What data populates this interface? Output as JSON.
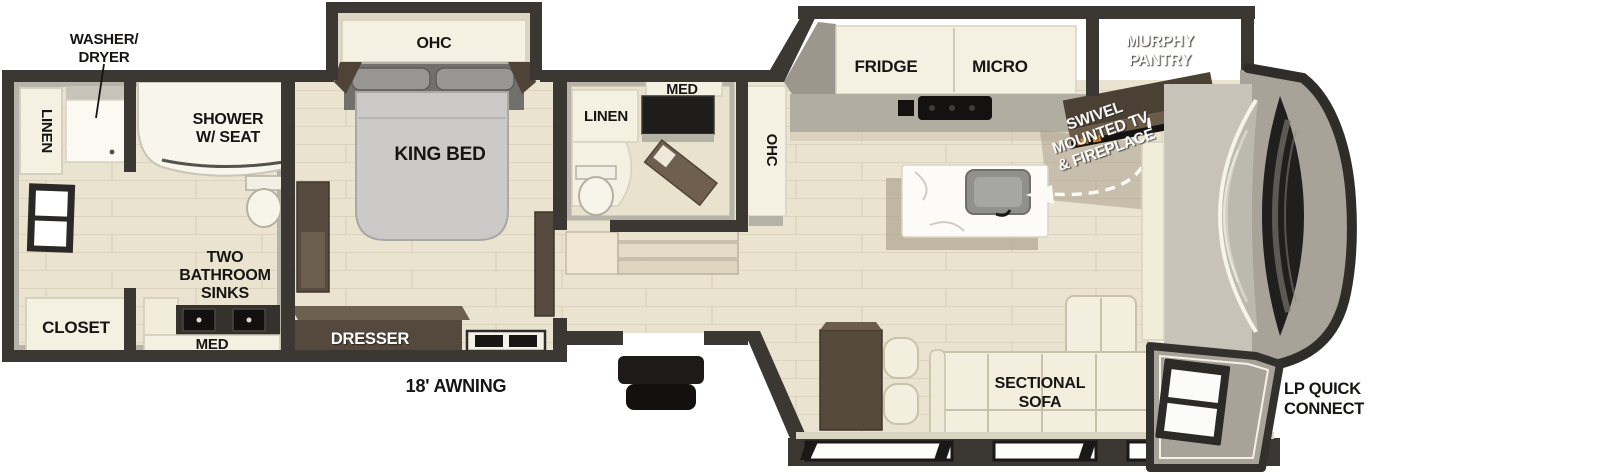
{
  "diagram": {
    "type": "rv-floorplan",
    "labels": {
      "washer_dryer": [
        "WASHER/",
        "DRYER"
      ],
      "linen_rear": "LINEN",
      "shower": [
        "SHOWER",
        "W/ SEAT"
      ],
      "closet": "CLOSET",
      "two_bathroom_sinks": [
        "TWO",
        "BATHROOM",
        "SINKS"
      ],
      "med_rear": "MED",
      "ohc_bedroom": "OHC",
      "king_bed": "KING BED",
      "dresser": "DRESSER",
      "awning": "18' AWNING",
      "linen_mid": "LINEN",
      "med_mid": "MED",
      "ohc_kitchen": "OHC",
      "fridge": "FRIDGE",
      "micro": "MICRO",
      "murphy_pantry": [
        "MURPHY",
        "PANTRY"
      ],
      "swivel_tv": [
        "SWIVEL",
        "MOUNTED TV",
        "& FIREPLACE"
      ],
      "sectional_sofa": [
        "SECTIONAL",
        "SOFA"
      ],
      "lp_quick_connect": [
        "LP QUICK",
        "CONNECT"
      ]
    },
    "colors": {
      "wall_dark": "#3b3834",
      "wall_light": "#b6b3a9",
      "floor": "#eae3cf",
      "cabinet_white": "#f5f1e2",
      "counter_gray": "#b1ada1",
      "wood_dark": "#564a3d",
      "bed_gray": "#cbcac8",
      "appliance_black": "#141312",
      "fire_orange": "#e08a1e",
      "label_black": "#161514",
      "label_white": "#ffffff"
    }
  }
}
